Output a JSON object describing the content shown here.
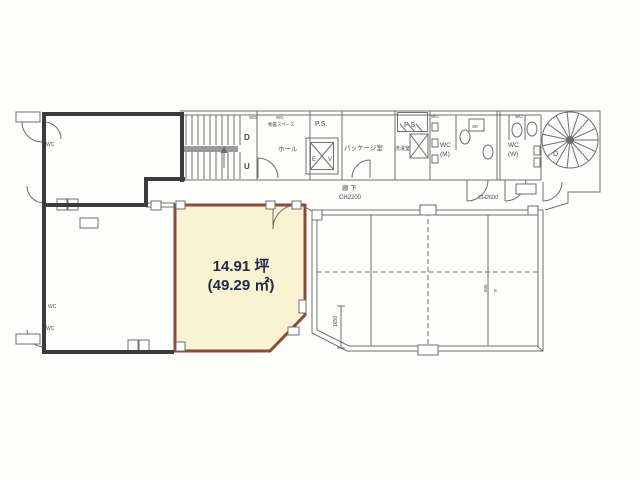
{
  "floorplan": {
    "highlight": {
      "area_tsubo": "14.91 坪",
      "area_sqm": "(49.29 ㎡)",
      "fill": "#faf3d2",
      "border": "#8b4a3a"
    },
    "labels": {
      "wc_upper_left": "WC",
      "wc_lower_left_1": "WC",
      "wc_lower_left_2": "WC",
      "stairs_down": "D",
      "stairs_up": "U",
      "wg_1": "WG",
      "wg_2": "WG",
      "storage": "物置スペース",
      "hall": "ホール",
      "ps": "P.S.",
      "elevator_e": "E",
      "elevator_v": "V",
      "package_room": "パッケージ室",
      "ps_small": "P S",
      "laundry": "洗濯室",
      "sk": "SK",
      "wc_m_line1": "WC",
      "wc_m_line2": "(M)",
      "wc_w_line1": "WC",
      "wc_w_line2": "(W)",
      "wg_3": "WG",
      "wg_4": "WG",
      "spiral_down": "D",
      "corridor": "廊 下",
      "ch_corridor": "CH2200",
      "ch_east": "CH2600",
      "dim_1650": "1650",
      "dim_500": "500",
      "grid_e": "E"
    },
    "colors": {
      "wall_dark": "#3c3c3c",
      "line": "#6e6e6e",
      "area_text": "#1e2947"
    }
  }
}
